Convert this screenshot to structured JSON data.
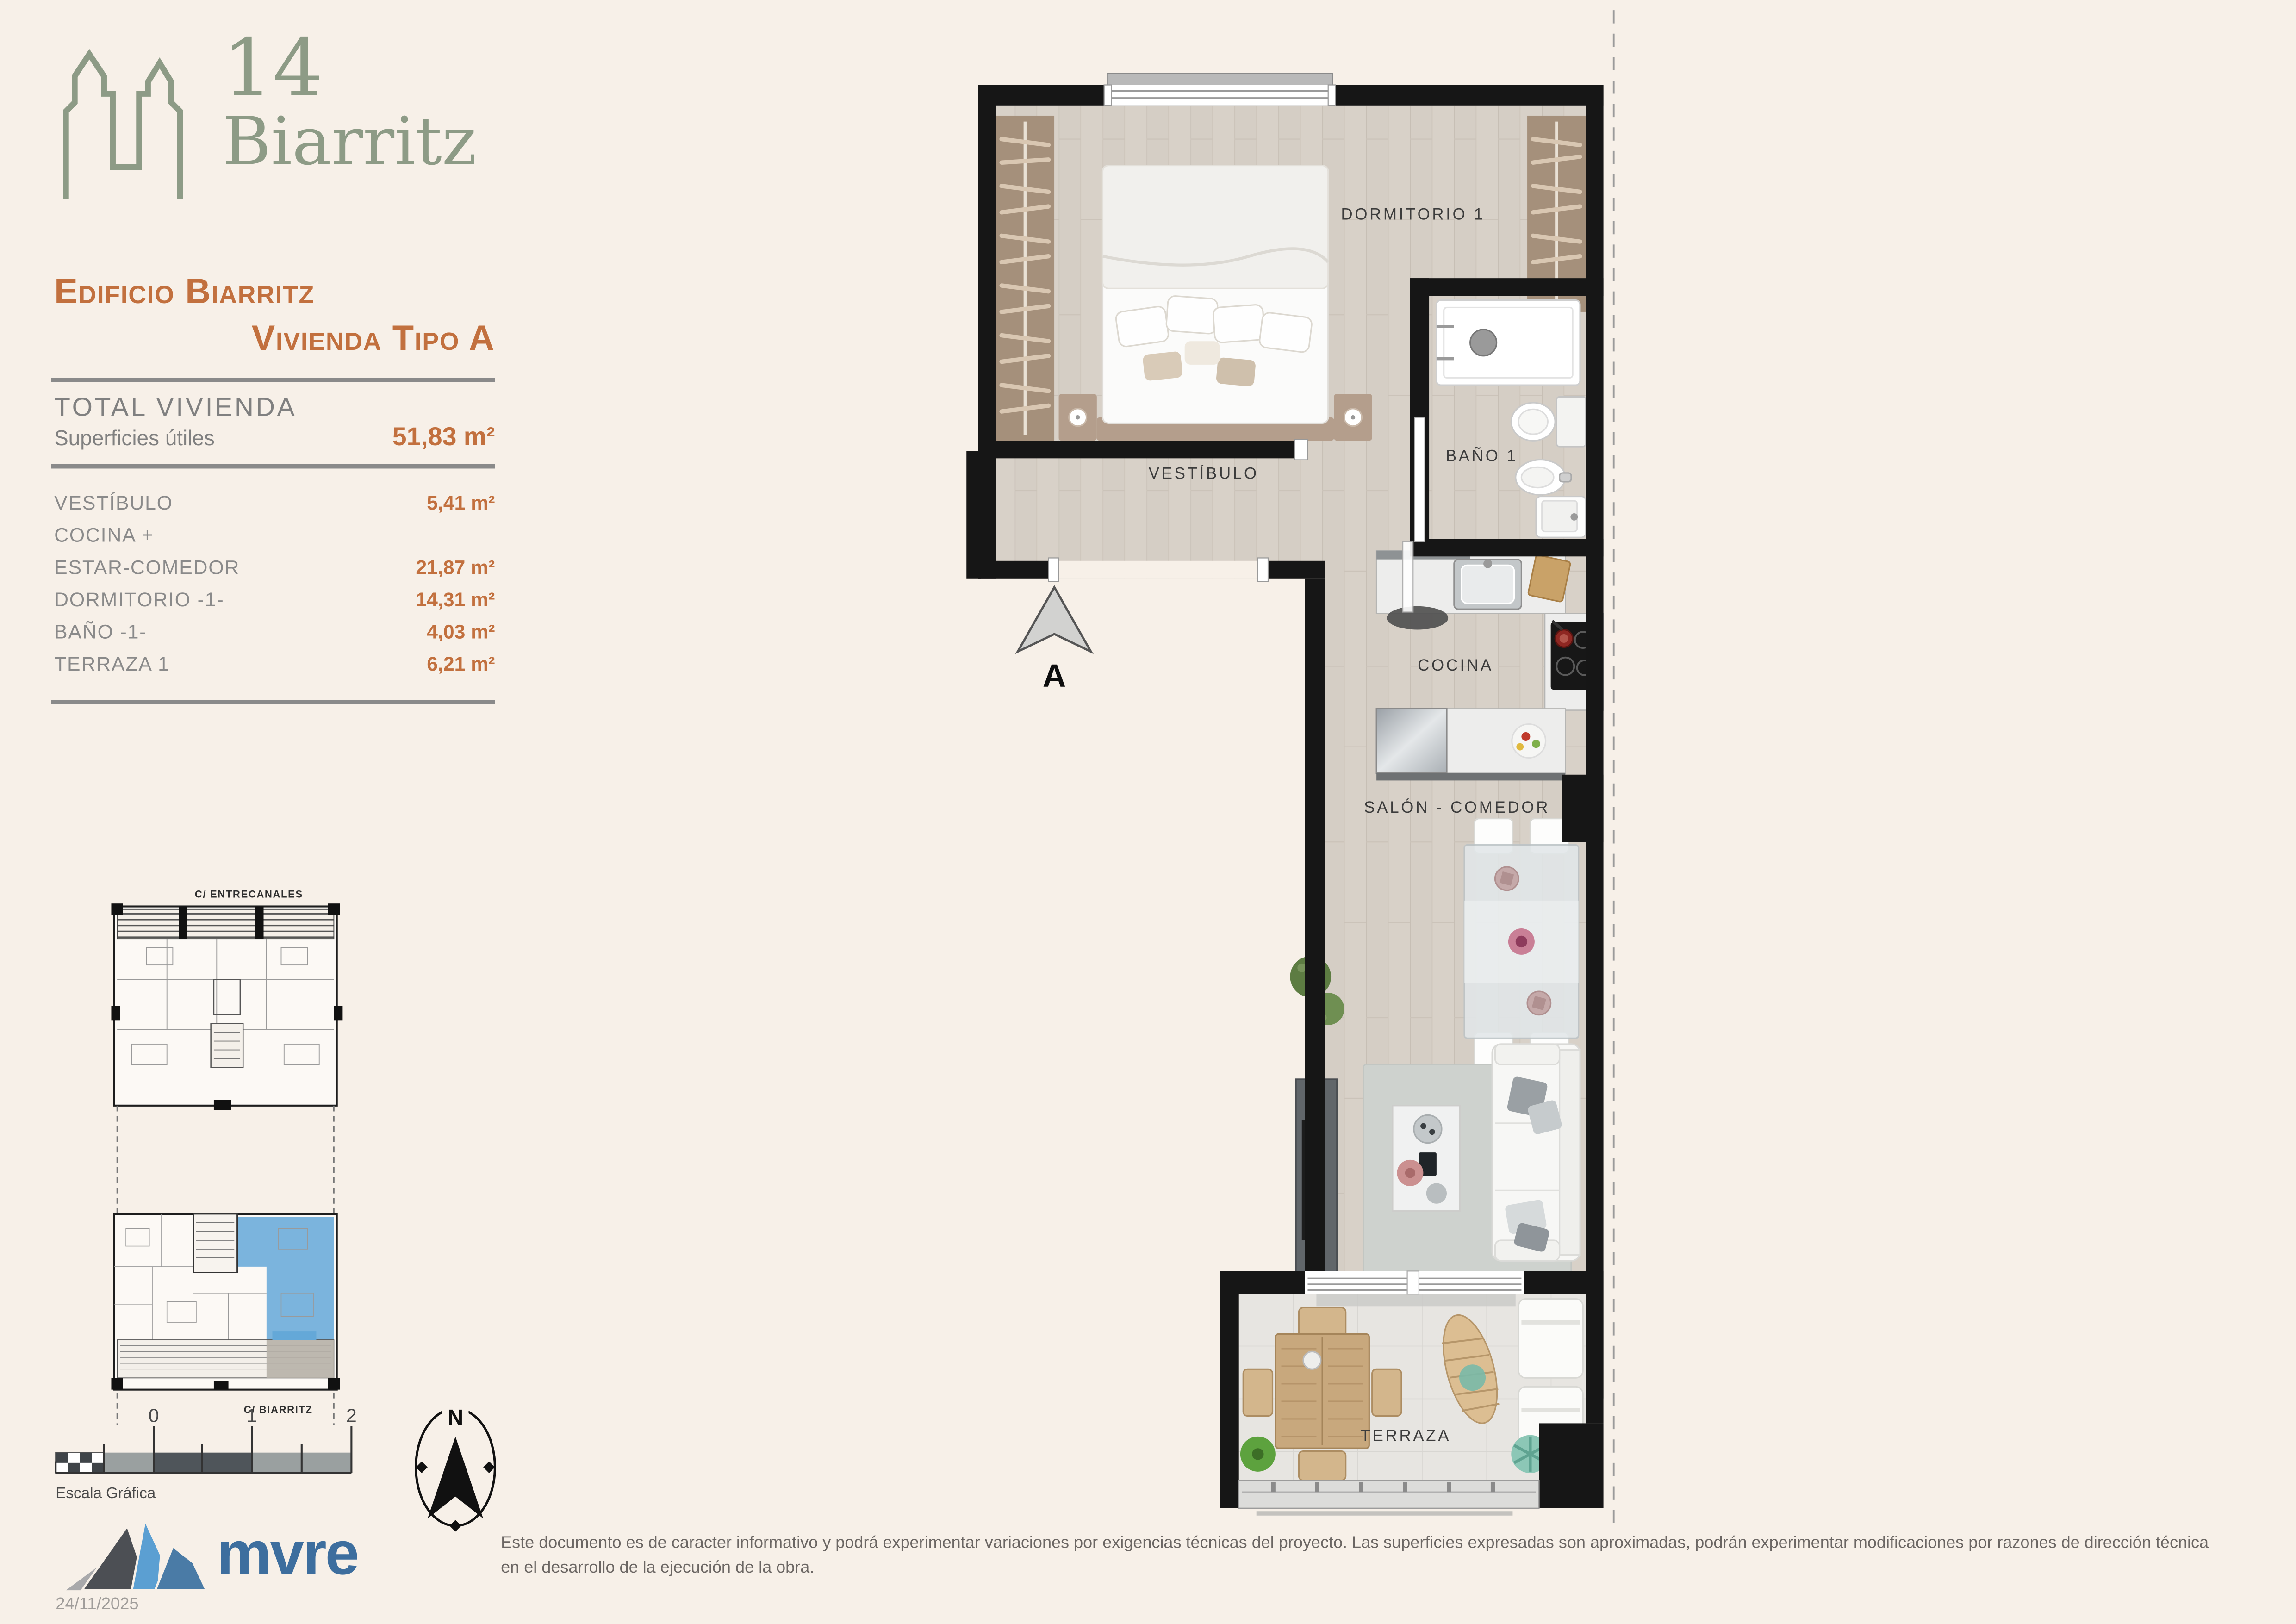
{
  "brand": {
    "number_text": "14",
    "name_text": "Biarritz"
  },
  "title": {
    "line1": "Edificio Biarritz",
    "line2": "Vivienda Tipo A"
  },
  "summary": {
    "heading": "TOTAL VIVIENDA",
    "label": "Superficies útiles",
    "value": "51,83 m²"
  },
  "rooms": [
    {
      "label": "VESTÍBULO",
      "value": "5,41 m²"
    },
    {
      "label": "COCINA +",
      "value": ""
    },
    {
      "label": "ESTAR-COMEDOR",
      "value": "21,87 m²"
    },
    {
      "label": "DORMITORIO -1-",
      "value": "14,31 m²"
    },
    {
      "label": "BAÑO -1-",
      "value": "4,03 m²"
    },
    {
      "label": "TERRAZA 1",
      "value": "6,21 m²"
    }
  ],
  "plan_labels": {
    "bedroom": "DORMITORIO 1",
    "vestibule": "VESTÍBULO",
    "bath": "BAÑO 1",
    "kitchen": "COCINA",
    "living": "SALÓN - COMEDOR",
    "terrace": "TERRAZA",
    "section_marker": "A"
  },
  "site_plan": {
    "street_top": "C/ ENTRECANALES",
    "street_bottom": "C/ BIARRITZ",
    "highlight_color": "#64a8d8"
  },
  "scale_bar": {
    "labels": [
      "0",
      "1",
      "2"
    ],
    "caption": "Escala Gráfica"
  },
  "compass": {
    "label": "N"
  },
  "footer": {
    "logo_text": "mvre",
    "date": "24/11/2025",
    "disclaimer": "Este documento es de caracter informativo y podrá experimentar variaciones por exigencias técnicas del proyecto. Las superficies expresadas son aproximadas, podrán experimentar modificaciones por razones de dirección técnica en el desarrollo de la ejecución de la obra."
  },
  "colors": {
    "background": "#f7f0e8",
    "accent_orange": "#c2703e",
    "brand_green": "#8d9b86",
    "text_gray": "#8a8a8a",
    "logo_blue": "#3d6e9e",
    "wall_black": "#161616",
    "wood_floor": "#d8d1c8",
    "unit_highlight": "#64a8d8"
  }
}
